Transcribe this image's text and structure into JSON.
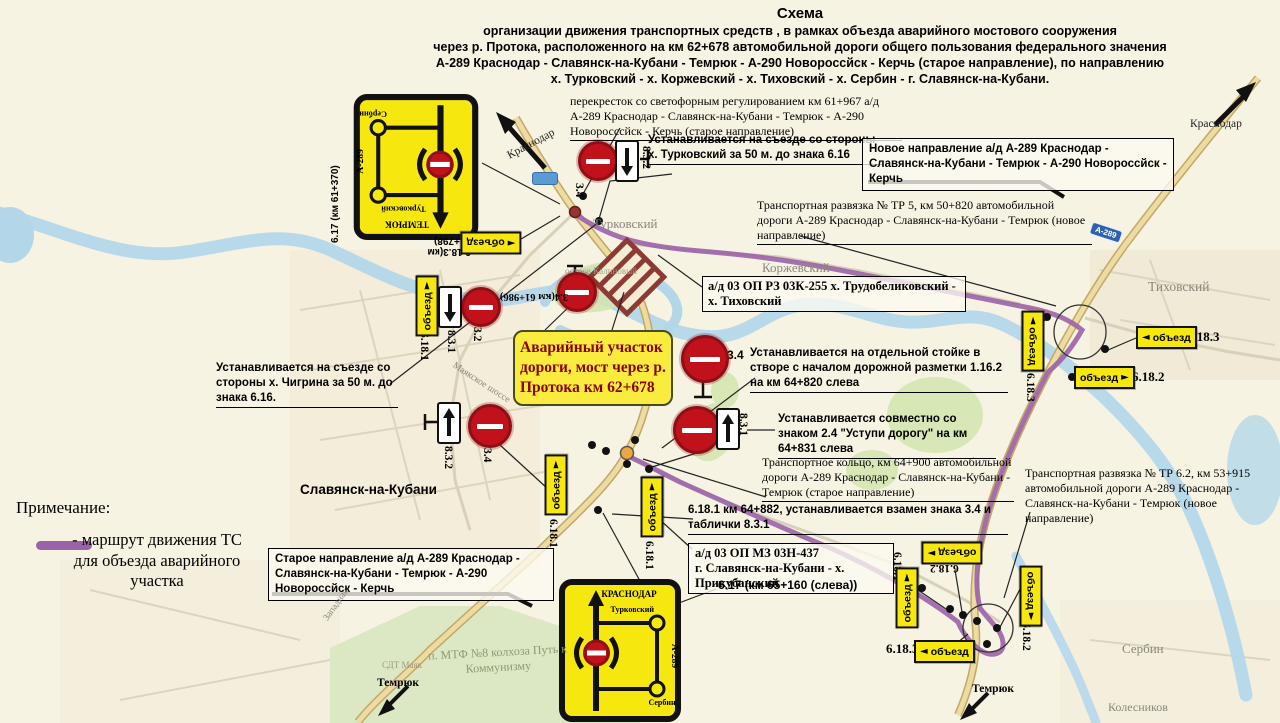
{
  "title": {
    "heading": "Схема",
    "line1": "организации движения транспортных средств , в рамках объезда аварийного мостового сооружения",
    "line2": "через р. Протока, расположенного на км 62+678 автомобильной дороги общего пользования федерального значения",
    "line3": "А-289 Краснодар - Славянск-на-Кубани - Темрюк - А-290 Новороссйск - Керчь (старое направление), по направлению",
    "line4": "х. Турковский - х. Коржевский - х. Тиховский - х. Сербин - г. Славянск-на-Кубани."
  },
  "notes": {
    "intersection": "перекресток со светофорным регулированием км 61+967 а/д А-289 Краснодар - Славянск-на-Кубани - Темрюк - А-290 Новоросссйск - Керчь (старое направление)",
    "turkovsky_exit": "Устанавливается на съезде со стороны х. Турковский за 50 м. до знака 6.16",
    "new_direction": "Новое направление а/д А-289 Краснодар - Славянск-на-Кубани - Темрюк - А-290 Новороссйск - Керчь",
    "tr5": "Транспортная развязка № ТР 5, км 50+820 автомобильной дороги А-289 Краснодар - Славянск-на-Кубани - Темрюк (новое направление)",
    "road_03k255": "а/д 03 ОП РЗ 03К-255 х. Трудобеликовский - х. Тиховский",
    "emergency": "Аварийный участок дороги, мост через р. Протока км 62+678",
    "separate_stand_prefix": "3.4",
    "separate_stand": "Устанавливается на отдельной стойке в створе с началом дорожной разметки 1.16.2 на км 64+820 слева",
    "give_way": "Устанавливается совместно со знаком 2.4 \"Уступи дорогу\" на км 64+831 слева",
    "ring": "Транспортное кольцо, км 64+900 автомобильной дороги А-289 Краснодар - Славянск-на-Кубани - Темрюк (старое направление)",
    "sign_6181_replace": "6.18.1  км 64+882, устанавливается взамен знака 3.4 и таблички 8.3.1",
    "road_03n437_line1": "а/д 03 ОП МЗ 03Н-437",
    "road_03n437_line2": "г. Славянск-на-Кубани - х. Прикубанский",
    "sign_617_bottom": "6.17 (км 65+160 (слева))",
    "old_direction": "Старое направление а/д А-289 Краснодар - Славянск-на-Кубани - Темрюк - А-290 Новороссйск - Керчь",
    "chigrina_exit": "Устанавливается на съезде со стороны х. Чигрина за 50 м. до знака 6.16.",
    "tr62": "Транспортная развязка № ТР 6.2, км 53+915 автомобильной дороги А-289 Краснодар - Славянск-на-Кубани - Темрюк (новое направление)"
  },
  "legend": {
    "heading": "Примечание:",
    "route_line1": "- маршрут движения ТС",
    "route_line2": "для объезда аварийного",
    "route_line3": "участка"
  },
  "sign_labels": {
    "s34": "3.4",
    "s32": "3.2",
    "s831": "8.3.1",
    "s832": "8.3.2",
    "s6181": "6.18.1",
    "s6182": "6.18.2",
    "s6183": "6.18.3",
    "s34km": "3.4(км 61+986)",
    "s6183km": "6.18.3(км 61+798)",
    "s617km_top": "6.17 (км 61+370)",
    "detour": "объезд"
  },
  "scheme_sign": {
    "top_sign_dest": "ТЕМРЮК",
    "bottom_sign_dest": "КРАСНОДАР",
    "turkovsky": "Турковский",
    "serbin": "Сербин",
    "a289": "А-289"
  },
  "places": {
    "krasnodar_top": "Краснодар",
    "krasnodar_ne": "Краснодар",
    "turkovsky": "Турковский",
    "korzhevsky": "Коржевский",
    "tikhovsky": "Тиховский",
    "slavyansk": "Славянск-на-Кубани",
    "serbin": "Сербин",
    "kolesnikov": "Колесников",
    "mtf": "п. МТФ №8 колхоза Путь к Коммунизму",
    "temryuk_sw": "Темрюк",
    "temryuk_se": "Темрюк",
    "island": "остров Калиновый",
    "sdt": "СДТ Маяк",
    "shosse": "Маякское шоссе",
    "zapadnaya": "Западная",
    "a289_shield": "А-289"
  },
  "icons": {
    "arrow_left": "◄",
    "arrow_right": "►"
  },
  "colors": {
    "route_purple": "#9a63a8",
    "road_tan": "#ecdca4",
    "sign_yellow": "#f6e70f",
    "no_entry_red": "#c1121c",
    "river_blue": "#b3d7e9",
    "green": "#d2e5ae",
    "emergency_text": "#8b0000"
  }
}
